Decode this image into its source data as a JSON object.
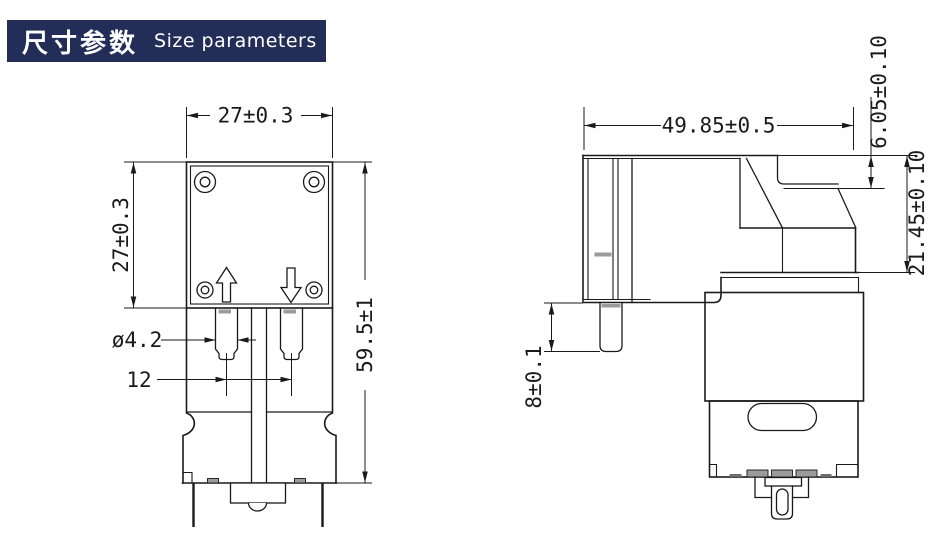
{
  "header": {
    "title_zh": "尺寸参数",
    "title_en": "Size parameters",
    "badge_bg": "#222d58",
    "text_color": "#ffffff"
  },
  "drawing_style": {
    "line_color": "#1a1a1a",
    "shade_color": "#9b9b9b",
    "background": "#ffffff"
  },
  "views": {
    "front": {
      "label": "front-view",
      "dims": {
        "head_width": "27±0.3",
        "head_height": "27±0.3",
        "overall_height": "59.5±1",
        "port_diameter": "ø4.2",
        "port_center_distance": "12"
      }
    },
    "side": {
      "label": "side-view",
      "dims": {
        "overall_width": "49.85±0.5",
        "top_step_height": "6.05±0.10",
        "bracket_height": "21.45±0.10",
        "port_length": "8±0.1"
      }
    }
  }
}
